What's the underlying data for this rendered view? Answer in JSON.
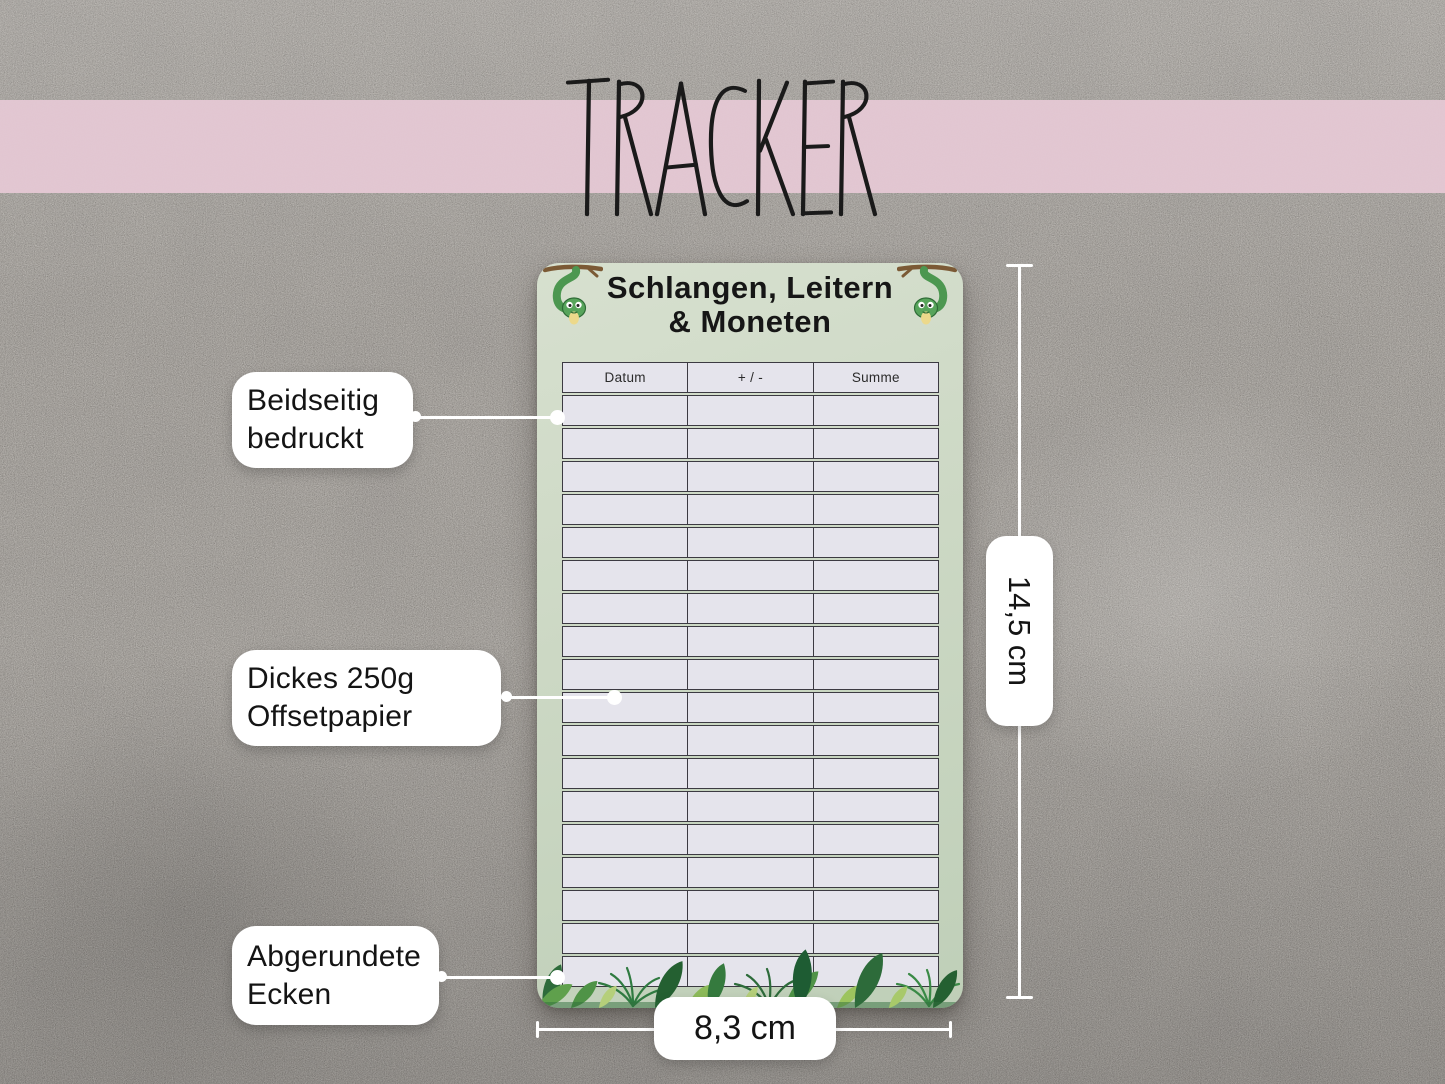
{
  "banner": {
    "title": "TRACKER"
  },
  "card": {
    "title_line1": "Schlangen, Leitern",
    "title_line2": "& Moneten",
    "table": {
      "headers": [
        "Datum",
        "+ / -",
        "Summe"
      ],
      "row_count": 18
    }
  },
  "callouts": [
    {
      "id": "double-sided-print",
      "text": "Beidseitig bedruckt"
    },
    {
      "id": "paper-weight",
      "text": "Dickes 250g Offsetpapier"
    },
    {
      "id": "rounded-corners",
      "text": "Abgerundete Ecken"
    }
  ],
  "dimensions": {
    "height_label": "14,5 cm",
    "width_label": "8,3 cm"
  },
  "colors": {
    "band_pink": "#e4c8d3",
    "card_green": "#ccd8c4",
    "table_cell": "#e5e4ec",
    "table_border": "#3c3a42",
    "callout_bg": "#ffffff",
    "text_black": "#1a1a1a"
  }
}
